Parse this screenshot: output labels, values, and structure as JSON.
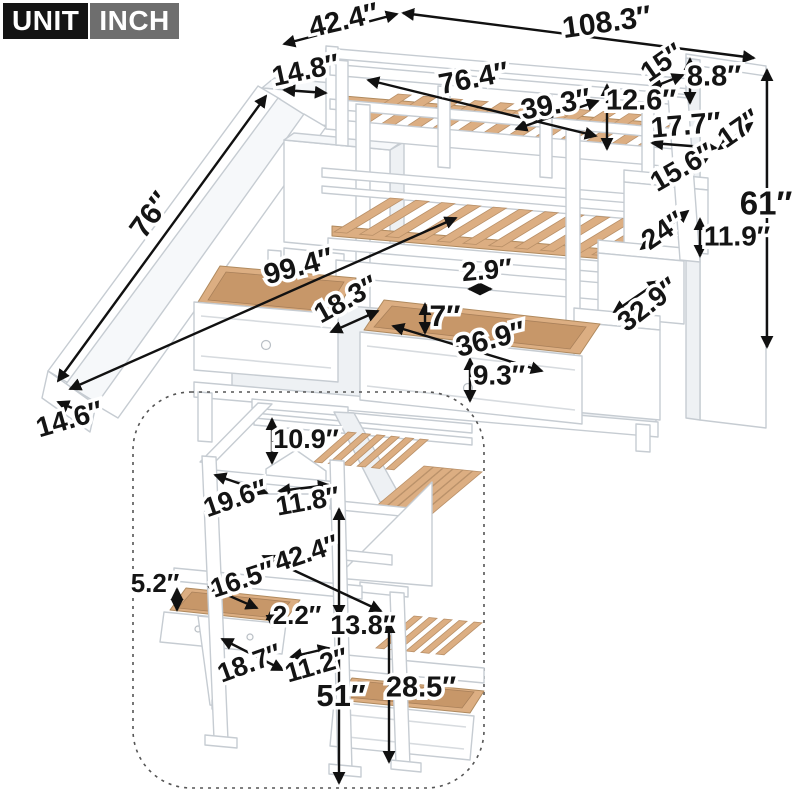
{
  "unit_badge": {
    "unit_label": "UNIT",
    "inch_label": "INCH"
  },
  "colors": {
    "label_text": "#141414",
    "label_halo": "#ffffff",
    "badge_unit_bg": "#141414",
    "badge_inch_bg": "#6e6e6e",
    "wood": "#dcae82",
    "wood_dark": "#c79769",
    "frame_white": "#ffffff",
    "frame_outline": "#c6ccd2"
  },
  "views": {
    "main": "bunk bed with slide, staircase storage and drawers (front view)",
    "inset": "house loft with desk, stairs and drawer bed (back view, dashed frame)"
  },
  "dimensions": [
    {
      "view": "main",
      "value": 42.4,
      "label": "42.4″",
      "x": 344,
      "y": 22,
      "rot": -13,
      "fs": 29,
      "x1": 284,
      "y1": 44,
      "x2": 397,
      "y2": 14,
      "heads": "both"
    },
    {
      "view": "main",
      "value": 108.3,
      "label": "108.3″",
      "x": 607,
      "y": 24,
      "rot": -8,
      "fs": 30,
      "x1": 403,
      "y1": 13,
      "x2": 754,
      "y2": 58,
      "heads": "both"
    },
    {
      "view": "main",
      "value": 14.8,
      "label": "14.8″",
      "x": 306,
      "y": 72,
      "rot": -12,
      "fs": 28,
      "x1": 284,
      "y1": 90,
      "x2": 326,
      "y2": 93,
      "heads": "both"
    },
    {
      "view": "main",
      "value": 76.4,
      "label": "76.4″",
      "x": 474,
      "y": 80,
      "rot": -11,
      "fs": 29,
      "x1": 368,
      "y1": 80,
      "x2": 596,
      "y2": 136,
      "heads": "both"
    },
    {
      "view": "main",
      "value": 39.3,
      "label": "39.3″",
      "x": 556,
      "y": 106,
      "rot": -10,
      "fs": 29,
      "x1": 516,
      "y1": 129,
      "x2": 598,
      "y2": 101,
      "heads": "both"
    },
    {
      "view": "main",
      "value": 12.6,
      "label": "12.6″",
      "x": 641,
      "y": 102,
      "rot": 0,
      "fs": 29,
      "x1": 607,
      "y1": 85,
      "x2": 607,
      "y2": 149,
      "heads": "both"
    },
    {
      "view": "main",
      "value": 15,
      "label": "15″",
      "x": 663,
      "y": 64,
      "rot": -35,
      "fs": 28,
      "x1": 651,
      "y1": 88,
      "x2": 683,
      "y2": 75,
      "heads": "both"
    },
    {
      "view": "main",
      "value": 8.8,
      "label": "8.8″",
      "x": 714,
      "y": 78,
      "rot": 0,
      "fs": 29,
      "x1": 690,
      "y1": 59,
      "x2": 690,
      "y2": 103,
      "heads": "both"
    },
    {
      "view": "main",
      "value": 17.7,
      "label": "17.7″",
      "x": 686,
      "y": 127,
      "rot": -5,
      "fs": 29,
      "x1": 652,
      "y1": 143,
      "x2": 716,
      "y2": 148,
      "heads": "both"
    },
    {
      "view": "main",
      "value": 17,
      "label": "17″",
      "x": 740,
      "y": 130,
      "rot": -35,
      "fs": 28,
      "x1": 719,
      "y1": 149,
      "x2": 752,
      "y2": 123,
      "heads": "both"
    },
    {
      "view": "main",
      "value": 15.6,
      "label": "15.6″",
      "x": 683,
      "y": 169,
      "rot": -30,
      "fs": 28,
      "x1": 660,
      "y1": 187,
      "x2": 707,
      "y2": 159,
      "heads": "both"
    },
    {
      "view": "main",
      "value": 24,
      "label": "24″",
      "x": 664,
      "y": 232,
      "rot": -34,
      "fs": 28,
      "x1": 641,
      "y1": 249,
      "x2": 688,
      "y2": 211,
      "heads": "both"
    },
    {
      "view": "main",
      "value": 11.9,
      "label": "11.9″",
      "x": 737,
      "y": 238,
      "rot": 0,
      "fs": 28,
      "x1": 700,
      "y1": 219,
      "x2": 700,
      "y2": 256,
      "heads": "both"
    },
    {
      "view": "main",
      "value": 61,
      "label": "61″",
      "x": 766,
      "y": 206,
      "rot": 0,
      "fs": 33,
      "x1": 767,
      "y1": 70,
      "x2": 767,
      "y2": 347,
      "heads": "both"
    },
    {
      "view": "main",
      "value": 32.9,
      "label": "32.9″",
      "x": 649,
      "y": 306,
      "rot": -38,
      "fs": 28,
      "x1": 614,
      "y1": 312,
      "x2": 659,
      "y2": 281,
      "heads": "both"
    },
    {
      "view": "main",
      "value": 76,
      "label": "76″",
      "x": 152,
      "y": 216,
      "rot": -54,
      "fs": 30,
      "x1": 266,
      "y1": 96,
      "x2": 58,
      "y2": 381,
      "heads": "both"
    },
    {
      "view": "main",
      "value": 99.4,
      "label": "99.4″",
      "x": 299,
      "y": 268,
      "rot": -15,
      "fs": 29,
      "x1": 70,
      "y1": 389,
      "x2": 456,
      "y2": 218,
      "heads": "both"
    },
    {
      "view": "main",
      "value": 14.6,
      "label": "14.6″",
      "x": 70,
      "y": 421,
      "rot": -16,
      "fs": 28,
      "x1": 58,
      "y1": 402,
      "x2": 91,
      "y2": 416,
      "heads": "both"
    },
    {
      "view": "main",
      "value": 18.3,
      "label": "18.3″",
      "x": 347,
      "y": 301,
      "rot": -29,
      "fs": 28,
      "x1": 331,
      "y1": 332,
      "x2": 378,
      "y2": 311,
      "heads": "both"
    },
    {
      "view": "main",
      "value": 2.9,
      "label": "2.9″",
      "x": 487,
      "y": 272,
      "rot": -5,
      "fs": 27,
      "x1": 469,
      "y1": 289,
      "x2": 491,
      "y2": 289,
      "heads": "both"
    },
    {
      "view": "main",
      "value": 7,
      "label": "7″",
      "x": 445,
      "y": 318,
      "rot": 0,
      "fs": 30,
      "x1": 425,
      "y1": 304,
      "x2": 425,
      "y2": 333,
      "heads": "both"
    },
    {
      "view": "main",
      "value": 36.9,
      "label": "36.9″",
      "x": 491,
      "y": 341,
      "rot": -14,
      "fs": 29,
      "x1": 393,
      "y1": 326,
      "x2": 542,
      "y2": 371,
      "heads": "both"
    },
    {
      "view": "main",
      "value": 9.3,
      "label": "9.3″",
      "x": 499,
      "y": 377,
      "rot": 0,
      "fs": 28,
      "x1": 470,
      "y1": 359,
      "x2": 470,
      "y2": 401,
      "heads": "both"
    },
    {
      "view": "inset",
      "value": 10.9,
      "label": "10.9″",
      "x": 306,
      "y": 441,
      "rot": 0,
      "fs": 27,
      "x1": 272,
      "y1": 419,
      "x2": 272,
      "y2": 463,
      "heads": "both"
    },
    {
      "view": "inset",
      "value": 19.6,
      "label": "19.6″",
      "x": 236,
      "y": 500,
      "rot": -19,
      "fs": 27,
      "x1": 215,
      "y1": 475,
      "x2": 267,
      "y2": 493,
      "heads": "both"
    },
    {
      "view": "inset",
      "value": 11.8,
      "label": "11.8″",
      "x": 308,
      "y": 503,
      "rot": -10,
      "fs": 27,
      "x1": 279,
      "y1": 491,
      "x2": 329,
      "y2": 485,
      "heads": "both"
    },
    {
      "view": "inset",
      "value": 42.4,
      "label": "42.4″",
      "x": 307,
      "y": 555,
      "rot": -18,
      "fs": 27,
      "x1": 263,
      "y1": 556,
      "x2": 381,
      "y2": 611,
      "heads": "both"
    },
    {
      "view": "inset",
      "value": 16.5,
      "label": "16.5″",
      "x": 243,
      "y": 581,
      "rot": -18,
      "fs": 27,
      "x1": 209,
      "y1": 587,
      "x2": 257,
      "y2": 608,
      "heads": "both"
    },
    {
      "view": "inset",
      "value": 5.2,
      "label": "5.2″",
      "x": 155,
      "y": 585,
      "rot": 0,
      "fs": 26,
      "x1": 177,
      "y1": 589,
      "x2": 177,
      "y2": 610,
      "heads": "both"
    },
    {
      "view": "inset",
      "value": 2.2,
      "label": "2.2″",
      "x": 297,
      "y": 617,
      "rot": 0,
      "fs": 26,
      "x1": 272,
      "y1": 609,
      "x2": 272,
      "y2": 626,
      "heads": "both"
    },
    {
      "view": "inset",
      "value": 13.8,
      "label": "13.8″",
      "x": 363,
      "y": 627,
      "rot": 0,
      "fs": 27,
      "x1": 339,
      "y1": 509,
      "x2": 339,
      "y2": 616,
      "heads": "both"
    },
    {
      "view": "inset",
      "value": 11.2,
      "label": "11.2″",
      "x": 317,
      "y": 667,
      "rot": -16,
      "fs": 27,
      "x1": 291,
      "y1": 657,
      "x2": 329,
      "y2": 648,
      "heads": "both"
    },
    {
      "view": "inset",
      "value": 18.7,
      "label": "18.7″",
      "x": 250,
      "y": 665,
      "rot": -20,
      "fs": 27,
      "x1": 222,
      "y1": 639,
      "x2": 283,
      "y2": 670,
      "heads": "both"
    },
    {
      "view": "inset",
      "value": 51,
      "label": "51″",
      "x": 341,
      "y": 698,
      "rot": 0,
      "fs": 31,
      "x1": 339,
      "y1": 620,
      "x2": 339,
      "y2": 783,
      "heads": "end"
    },
    {
      "view": "inset",
      "value": 28.5,
      "label": "28.5″",
      "x": 421,
      "y": 689,
      "rot": 0,
      "fs": 29,
      "x1": 389,
      "y1": 622,
      "x2": 389,
      "y2": 762,
      "heads": "both"
    }
  ]
}
